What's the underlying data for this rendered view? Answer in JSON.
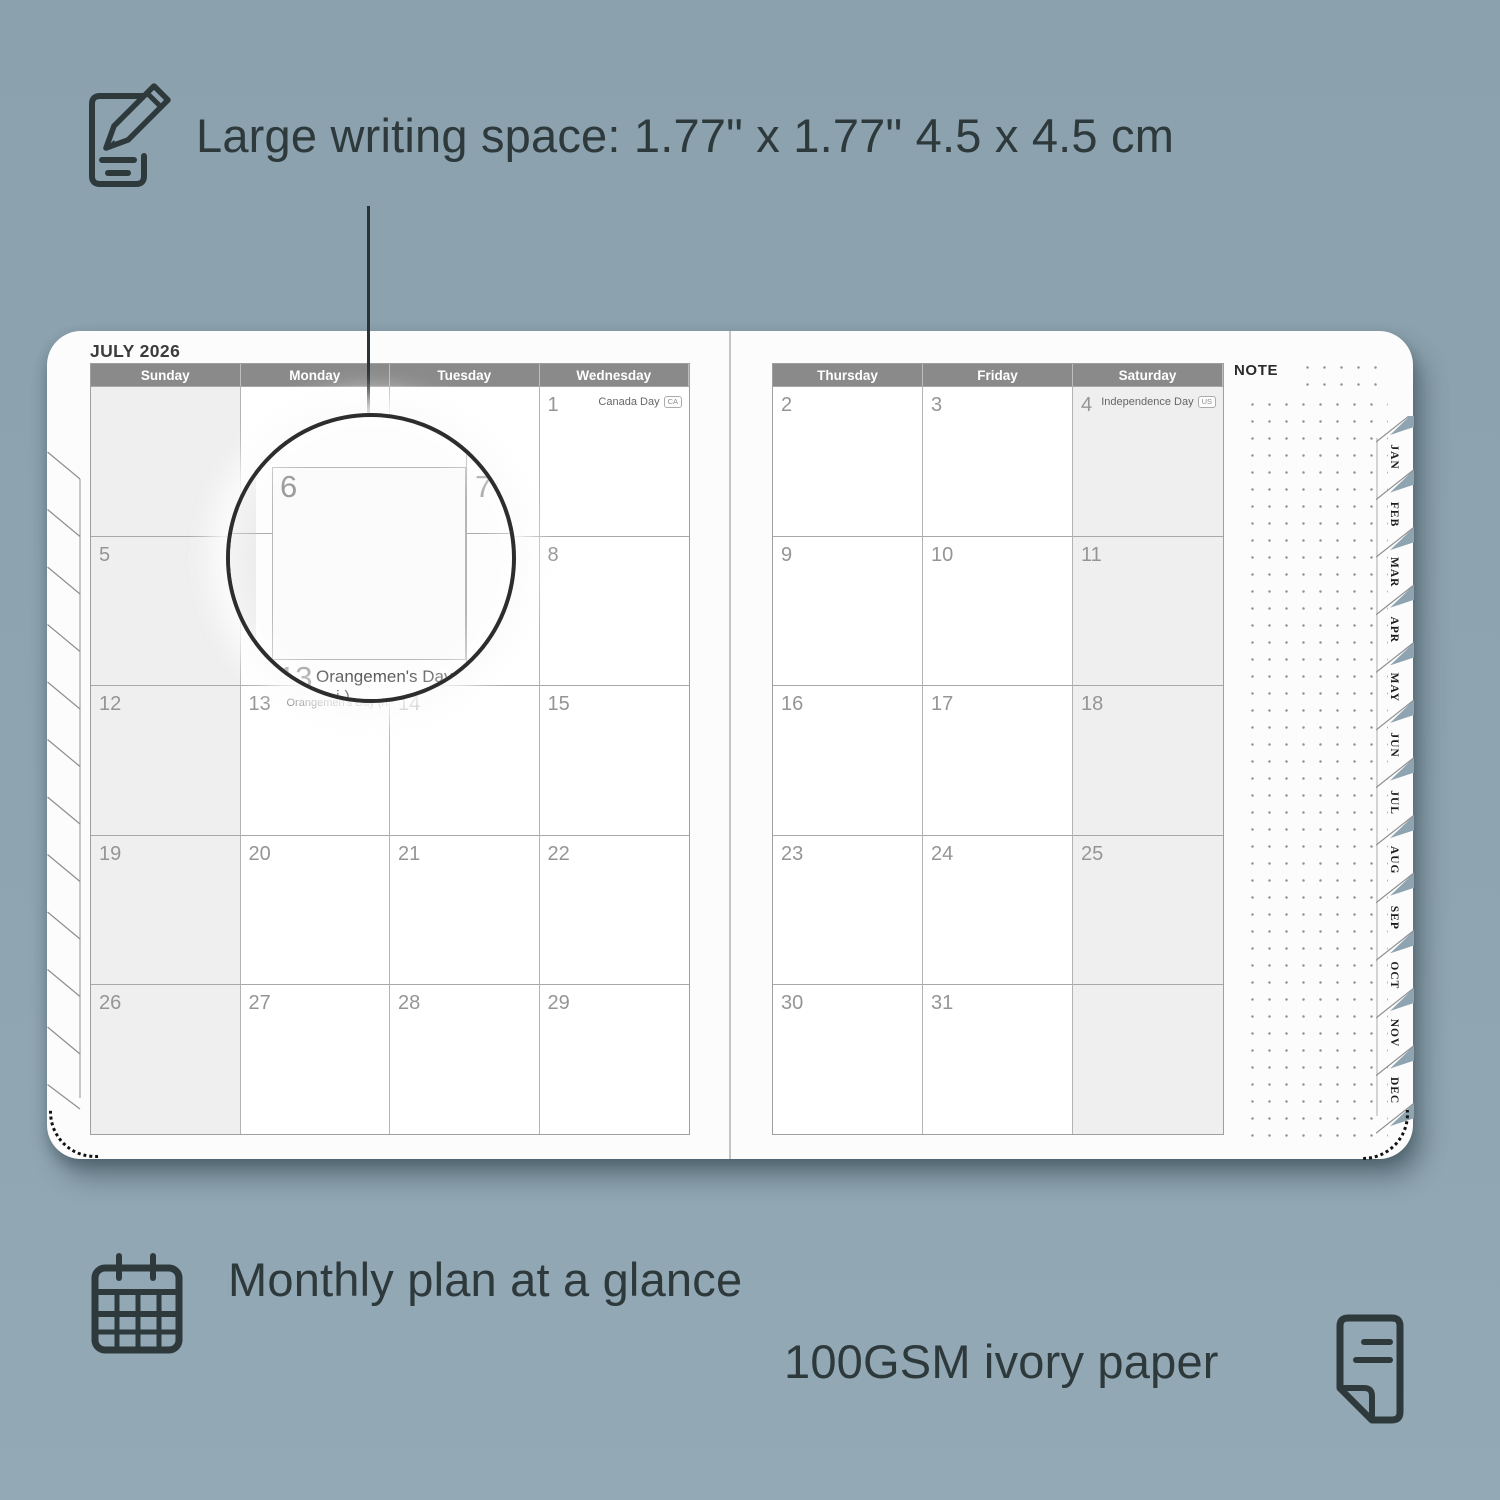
{
  "colors": {
    "background": "#8EA4B0",
    "ink": "#2E393C",
    "page": "#FCFCFC",
    "header_bar": "#8A8A8A",
    "shaded_cell": "#EFEFEF",
    "grid_line": "#B3B3B3",
    "date_number": "#959595"
  },
  "callout_top": {
    "label": "Large writing space: 1.77\" x 1.77\" 4.5 x 4.5 cm"
  },
  "callout_monthly": {
    "label": "Monthly plan at a glance"
  },
  "callout_paper": {
    "label": "100GSM ivory paper"
  },
  "planner": {
    "title": "JULY 2026",
    "note_label": "NOTE",
    "left": {
      "headers": [
        "Sunday",
        "Monday",
        "Tuesday",
        "Wednesday"
      ],
      "rows": [
        [
          {
            "d": ""
          },
          {
            "d": ""
          },
          {
            "d": ""
          },
          {
            "d": "1",
            "ev": "Canada Day",
            "badge": "CA"
          }
        ],
        [
          {
            "d": "5"
          },
          {
            "d": "6"
          },
          {
            "d": "7"
          },
          {
            "d": "8"
          }
        ],
        [
          {
            "d": "12"
          },
          {
            "d": "13",
            "ev": "Orangemen's Day (n.i.)",
            "badge": "UK"
          },
          {
            "d": "14"
          },
          {
            "d": "15"
          }
        ],
        [
          {
            "d": "19"
          },
          {
            "d": "20"
          },
          {
            "d": "21"
          },
          {
            "d": "22"
          }
        ],
        [
          {
            "d": "26"
          },
          {
            "d": "27"
          },
          {
            "d": "28"
          },
          {
            "d": "29"
          }
        ]
      ]
    },
    "right": {
      "headers": [
        "Thursday",
        "Friday",
        "Saturday"
      ],
      "rows": [
        [
          {
            "d": "2"
          },
          {
            "d": "3"
          },
          {
            "d": "4",
            "ev": "Independence Day",
            "badge": "US"
          }
        ],
        [
          {
            "d": "9"
          },
          {
            "d": "10"
          },
          {
            "d": "11"
          }
        ],
        [
          {
            "d": "16"
          },
          {
            "d": "17"
          },
          {
            "d": "18"
          }
        ],
        [
          {
            "d": "23"
          },
          {
            "d": "24"
          },
          {
            "d": "25"
          }
        ],
        [
          {
            "d": "30"
          },
          {
            "d": "31"
          },
          {
            "d": ""
          }
        ]
      ]
    },
    "tabs": [
      "JAN",
      "FEB",
      "MAR",
      "APR",
      "MAY",
      "JUN",
      "JUL",
      "AUG",
      "SEP",
      "OCT",
      "NOV",
      "DEC"
    ]
  },
  "magnifier": {
    "day": "6",
    "next_day": "7",
    "bottom_day": "13",
    "event": "Orangemen's Day (n.i.)",
    "badge": "UK"
  }
}
